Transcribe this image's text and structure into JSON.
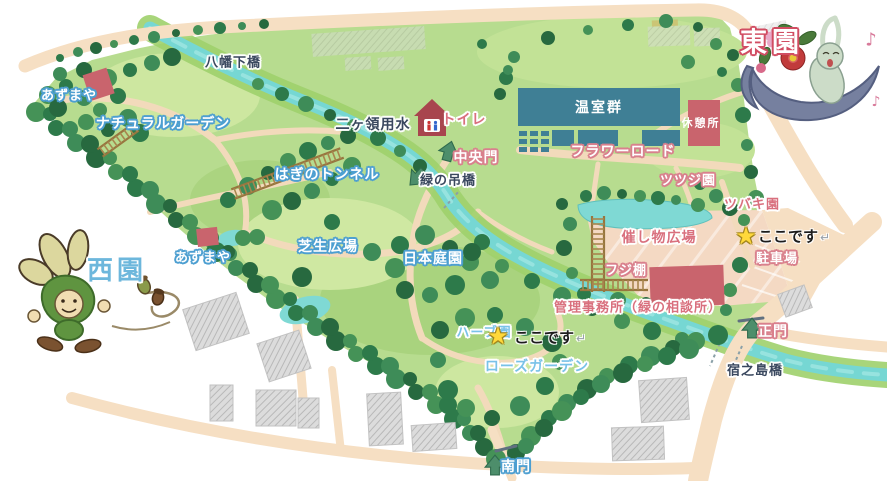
{
  "labels": [
    {
      "id": "yahatashita-bridge",
      "text": "八幡下橋",
      "x": 233,
      "y": 63,
      "style": "navy",
      "size": 13
    },
    {
      "id": "azumaya-northwest",
      "text": "あずまや",
      "x": 69,
      "y": 96,
      "style": "white-blue",
      "size": 13
    },
    {
      "id": "natural-garden",
      "text": "ナチュラルガーデン",
      "x": 163,
      "y": 124,
      "style": "white-blue",
      "size": 14
    },
    {
      "id": "nikaryo-canal",
      "text": "二ヶ領用水",
      "x": 373,
      "y": 125,
      "style": "navy",
      "size": 14
    },
    {
      "id": "toilet",
      "text": "トイレ",
      "x": 464,
      "y": 120,
      "style": "rose-white",
      "size": 14
    },
    {
      "id": "central-gate",
      "text": "中央門",
      "x": 476,
      "y": 158,
      "style": "white-rose",
      "size": 14
    },
    {
      "id": "greenhouses",
      "text": "温室群",
      "x": 599,
      "y": 108,
      "style": "white-plain",
      "size": 14
    },
    {
      "id": "rest-house",
      "text": "休憩所",
      "x": 701,
      "y": 123,
      "style": "white-plain",
      "size": 11
    },
    {
      "id": "flower-road",
      "text": "フラワーロード",
      "x": 623,
      "y": 152,
      "style": "white-rose",
      "size": 14
    },
    {
      "id": "hagi-tunnel",
      "text": "はぎのトンネル",
      "x": 327,
      "y": 175,
      "style": "white-blue",
      "size": 14
    },
    {
      "id": "green-suspension-bridge",
      "text": "緑の吊橋",
      "x": 448,
      "y": 181,
      "style": "navy-white",
      "size": 13
    },
    {
      "id": "azalea-garden",
      "text": "ツツジ園",
      "x": 688,
      "y": 181,
      "style": "white-rose",
      "size": 13
    },
    {
      "id": "camellia-garden",
      "text": "ツバキ園",
      "x": 752,
      "y": 205,
      "style": "rose-white",
      "size": 13
    },
    {
      "id": "event-plaza",
      "text": "催し物広場",
      "x": 659,
      "y": 238,
      "style": "rose-white",
      "size": 14
    },
    {
      "id": "azumaya-west",
      "text": "あずまや",
      "x": 203,
      "y": 258,
      "style": "white-blue",
      "size": 13
    },
    {
      "id": "lawn-plaza",
      "text": "芝生広場",
      "x": 328,
      "y": 247,
      "style": "white-blue",
      "size": 14
    },
    {
      "id": "japanese-garden",
      "text": "日本庭園",
      "x": 433,
      "y": 259,
      "style": "white-blue",
      "size": 14
    },
    {
      "id": "wisteria-trellis",
      "text": "フジ棚",
      "x": 626,
      "y": 271,
      "style": "white-rose",
      "size": 13
    },
    {
      "id": "parking",
      "text": "駐車場",
      "x": 777,
      "y": 259,
      "style": "white-rose",
      "size": 13
    },
    {
      "id": "admin-office",
      "text": "管理事務所（緑の相談所）",
      "x": 638,
      "y": 308,
      "style": "rose-white",
      "size": 13
    },
    {
      "id": "main-gate",
      "text": "正門",
      "x": 773,
      "y": 332,
      "style": "white-rose",
      "size": 14
    },
    {
      "id": "herb-garden",
      "text": "ハーブ園",
      "x": 484,
      "y": 333,
      "style": "lightblue-white",
      "size": 13
    },
    {
      "id": "rose-garden",
      "text": "ローズガーデン",
      "x": 537,
      "y": 367,
      "style": "lightblue-white",
      "size": 14
    },
    {
      "id": "shukunoshima-bridge",
      "text": "宿之島橋",
      "x": 755,
      "y": 371,
      "style": "navy",
      "size": 13
    },
    {
      "id": "south-gate",
      "text": "南門",
      "x": 516,
      "y": 467,
      "style": "white-blue",
      "size": 14
    },
    {
      "id": "west-area-title",
      "text": "西園",
      "x": 117,
      "y": 271,
      "style": "big-blue",
      "size": 26
    },
    {
      "id": "east-area-title",
      "text": "東園",
      "x": 772,
      "y": 43,
      "style": "big-rose",
      "size": 27
    }
  ],
  "markers": [
    {
      "id": "you-are-here-east",
      "star": "★",
      "text": "ここです",
      "arrow": "↵",
      "star_x": 746,
      "star_y": 236,
      "text_x": 758,
      "text_y": 236
    },
    {
      "id": "you-are-here-west",
      "star": "★",
      "text": "ここです",
      "arrow": "↵",
      "star_x": 498,
      "star_y": 336,
      "text_x": 514,
      "text_y": 337
    }
  ],
  "entrance_arrows": [
    {
      "id": "central-gate-arrow",
      "x": 449,
      "y": 151,
      "angle": 15
    },
    {
      "id": "suspension-bridge-arrow",
      "x": 417,
      "y": 178,
      "angle": -135
    },
    {
      "id": "main-gate-arrow",
      "x": 752,
      "y": 328,
      "angle": 0
    },
    {
      "id": "south-gate-arrow",
      "x": 495,
      "y": 465,
      "angle": 0
    }
  ],
  "decor": {
    "music_note_glyph": "♪",
    "music_notes": [
      {
        "x": 871,
        "y": 40,
        "size": 18
      },
      {
        "x": 876,
        "y": 102,
        "size": 14
      }
    ]
  },
  "colors": {
    "park_green": "#b7dc8f",
    "lawn_green": "#cfe8a2",
    "tree_green": "#2d7a4a",
    "river_cyan": "#76d7d3",
    "road_tan": "#f6dfc3",
    "building_red": "#c9646d",
    "greenhouse_teal": "#3f7f95",
    "plaza_pink": "#f4d9c3",
    "label_rose": "#d9707e",
    "label_blue": "#4d9fd1",
    "label_navy": "#39475e",
    "label_lightblue": "#79c2e8",
    "star_yellow": "#ffd83a",
    "arrow_green": "#4d8e6b",
    "outside_building_gray": "#d9d9d9"
  }
}
